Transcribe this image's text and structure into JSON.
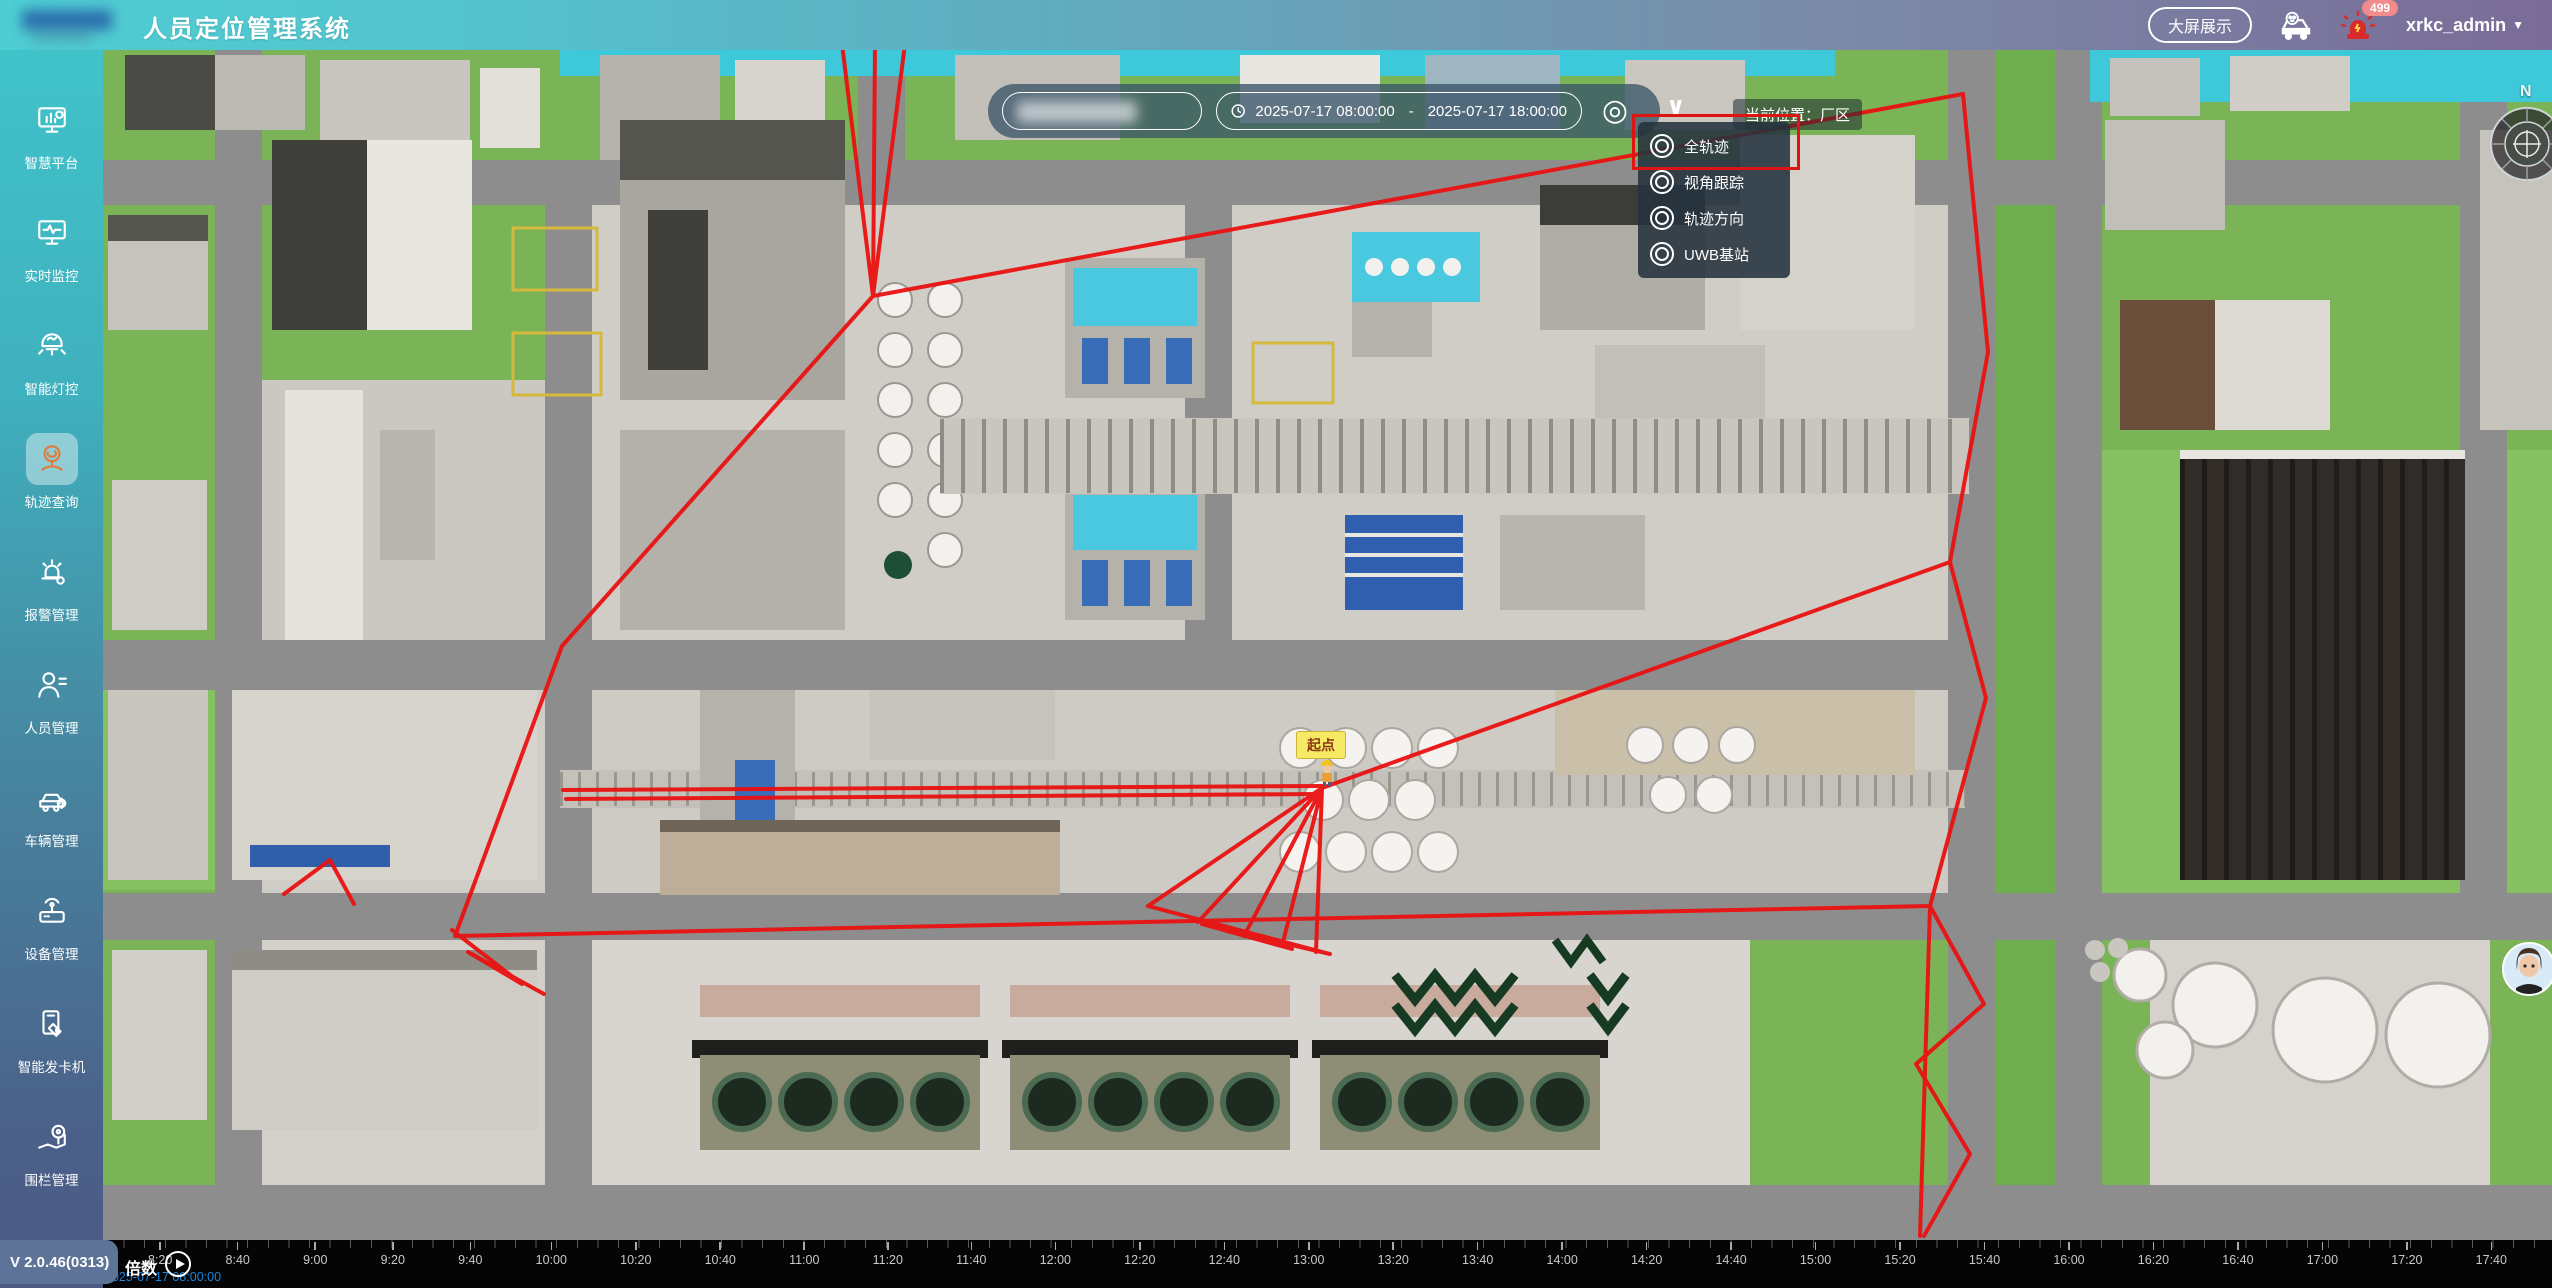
{
  "header": {
    "title": "人员定位管理系统",
    "big_screen_button": "大屏展示",
    "alarm_badge": "499",
    "username": "xrkc_admin"
  },
  "sidebar": {
    "version": "V 2.0.46(0313)",
    "items": [
      {
        "id": "smart-platform",
        "label": "智慧平台",
        "icon": "platform",
        "active": false
      },
      {
        "id": "realtime-monitor",
        "label": "实时监控",
        "icon": "monitor",
        "active": false
      },
      {
        "id": "smart-lighting",
        "label": "智能灯控",
        "icon": "light",
        "active": false
      },
      {
        "id": "trajectory-query",
        "label": "轨迹查询",
        "icon": "trajectory",
        "active": true
      },
      {
        "id": "alarm-management",
        "label": "报警管理",
        "icon": "alarm",
        "active": false
      },
      {
        "id": "personnel-management",
        "label": "人员管理",
        "icon": "person",
        "active": false
      },
      {
        "id": "vehicle-management",
        "label": "车辆管理",
        "icon": "vehicle",
        "active": false
      },
      {
        "id": "device-management",
        "label": "设备管理",
        "icon": "device",
        "active": false
      },
      {
        "id": "smart-card-dispenser",
        "label": "智能发卡机",
        "icon": "card",
        "active": false
      },
      {
        "id": "fence-management",
        "label": "围栏管理",
        "icon": "fence",
        "active": false
      }
    ]
  },
  "toolbar": {
    "date_start": "2025-07-17 08:00:00",
    "date_separator": "-",
    "date_end": "2025-07-17 18:00:00",
    "locate_icon": "◎",
    "chevron": "∨",
    "current_location": "当前位置：厂区"
  },
  "dropdown": {
    "items": [
      {
        "id": "full-trajectory",
        "label": "全轨迹"
      },
      {
        "id": "view-tracking",
        "label": "视角跟踪"
      },
      {
        "id": "trajectory-direction",
        "label": "轨迹方向"
      },
      {
        "id": "uwb-station",
        "label": "UWB基站"
      }
    ]
  },
  "map": {
    "start_point_label": "起点",
    "compass_north": "N"
  },
  "timeline": {
    "speed_label": "倍数",
    "current_time": "2025-07-17 08:00:00",
    "ticks": [
      "8:20",
      "8:40",
      "9:00",
      "9:20",
      "9:40",
      "10:00",
      "10:20",
      "10:40",
      "11:00",
      "11:20",
      "11:40",
      "12:00",
      "12:20",
      "12:40",
      "13:00",
      "13:20",
      "13:40",
      "14:00",
      "14:20",
      "14:40",
      "15:00",
      "15:20",
      "15:40",
      "16:00",
      "16:20",
      "16:40",
      "17:00",
      "17:20",
      "17:40"
    ]
  },
  "colors": {
    "accent_teal": "#41c3ca",
    "accent_purple": "#7a6c98",
    "trajectory_red": "#ea1111",
    "active_icon_orange": "#e07b39",
    "grass_green": "#7ab457",
    "pool_cyan": "#49c8e0"
  }
}
